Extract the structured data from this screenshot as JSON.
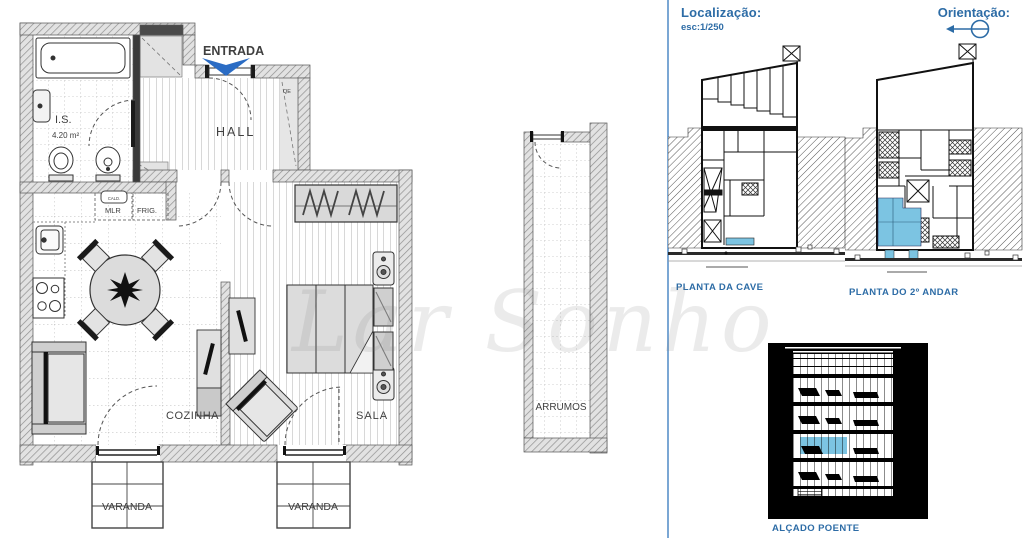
{
  "floor_plan": {
    "entrance": "ENTRADA",
    "hall": "HALL",
    "bathroom": "I.S.",
    "bathroom_area": "4.20 m²",
    "electrical_box": "QE",
    "boiler": "CALD.",
    "washer": "MLR",
    "fridge": "FRIG.",
    "kitchen": "COZINHA",
    "living_room": "SALA",
    "balcony_kitchen": "VARANDA",
    "balcony_living": "VARANDA",
    "storage": "ARRUMOS"
  },
  "watermark": "Lar Sonho",
  "panel": {
    "location_label": "Localização:",
    "scale": "esc:1/250",
    "orientation_label": "Orientação:",
    "basement_plan_label": "PLANTA DA CAVE",
    "second_floor_plan_label": "PLANTA DO 2º ANDAR",
    "west_elevation_label": "ALÇADO POENTE"
  },
  "colors": {
    "accent_blue": "#2d6ca6",
    "entrance_blue": "#1d5fb5",
    "highlight_blue": "#7cc4e2",
    "divider_blue": "#7ba7d4"
  }
}
